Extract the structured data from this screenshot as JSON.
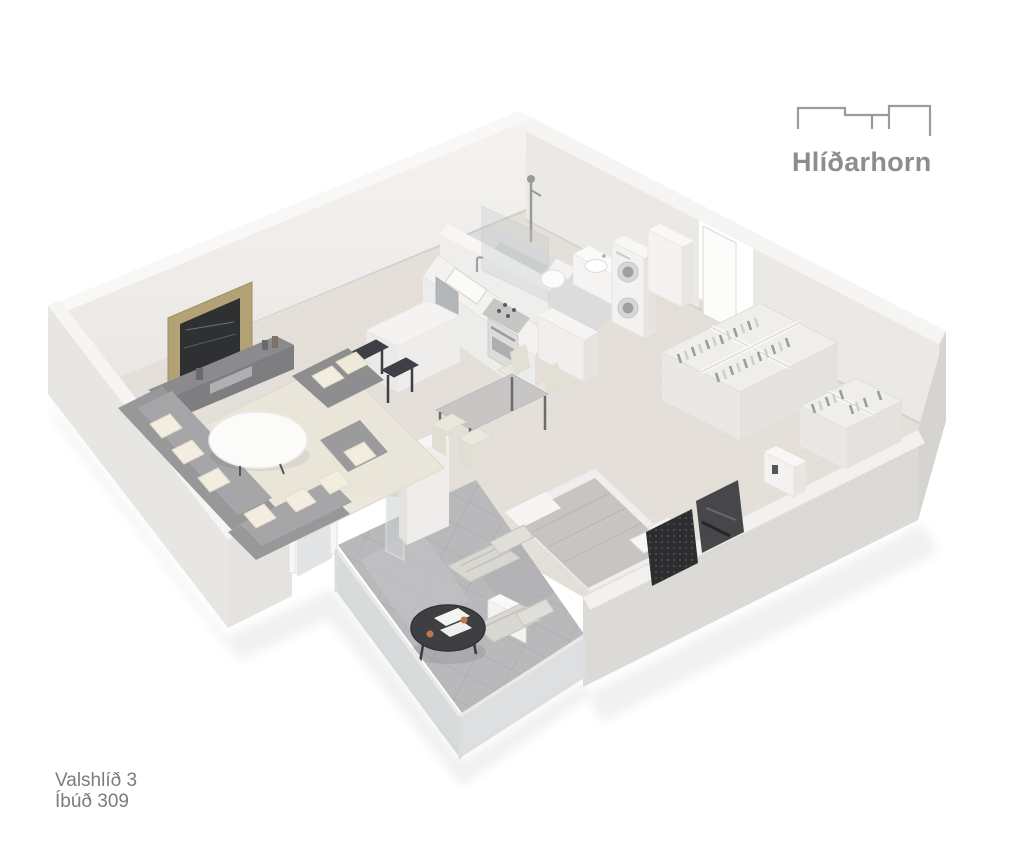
{
  "branding": {
    "name": "Hlíðarhorn",
    "logo_icon": "buildings-skyline-icon",
    "text_color": "#8d8d8d"
  },
  "labels": {
    "address_line1": "Valshlíð 3",
    "address_line2": "Íbúð 309",
    "text_color": "#7c7c7c"
  },
  "scene": {
    "type": "3d-isometric-apartment-floor-plan-render",
    "background": "#ffffff",
    "rooms": [
      "living-room",
      "kitchen",
      "dining-area",
      "bathroom",
      "laundry-corner",
      "entrance-hall",
      "bedroom",
      "wardrobe-area",
      "balcony"
    ],
    "furniture": [
      "tv-wall-panel",
      "media-console",
      "sectional-sofa",
      "coffee-table",
      "ottoman",
      "area-rug",
      "kitchen-island",
      "bar-stools",
      "kitchen-counter",
      "sink",
      "dishwasher",
      "cooktop",
      "oven",
      "tall-cabinet",
      "dining-table",
      "dining-chairs",
      "shower",
      "glass-partition",
      "toilet",
      "vanity-sink",
      "stacked-washer-dryer",
      "open-wardrobes-with-clothes",
      "dresser",
      "double-bed",
      "bed-bench",
      "art-panels",
      "balcony-table",
      "balcony-chairs",
      "glass-railing",
      "sliding-glass-door",
      "entrance-door"
    ]
  },
  "palette": {
    "background": "#ffffff",
    "wall_light": "#f4f2f0",
    "wall_shade": "#dcdad7",
    "floor_wood": "#e4e0d9",
    "floor_bathroom": "#dcdcdc",
    "floor_balcony": "#b9b8ba",
    "furniture_gray": "#98989b",
    "wood_accent": "#b2a276",
    "brand_text": "#8d8d8d",
    "label_text": "#7c7c7c"
  }
}
